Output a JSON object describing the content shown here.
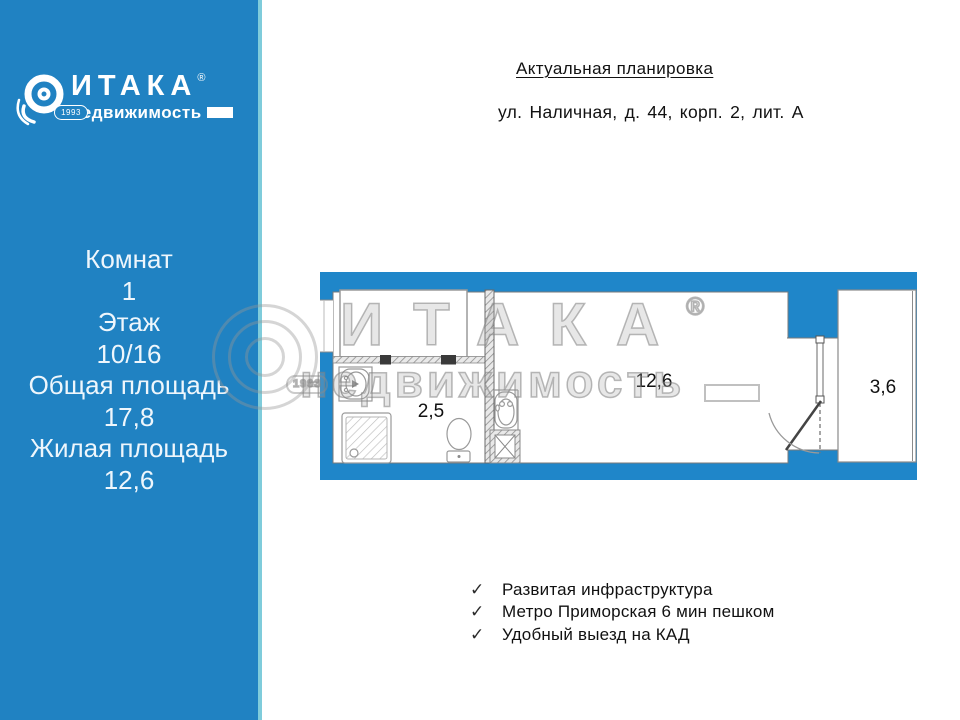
{
  "sidebar": {
    "logo": {
      "brand": "ИТАКА",
      "registered": "®",
      "subtitle": "недвижимость",
      "year_badge": "1993"
    },
    "details": [
      "Комнат",
      "1",
      "Этаж",
      "10/16",
      "Общая площадь",
      "17,8",
      "Жилая площадь",
      "12,6"
    ]
  },
  "header": {
    "title": "Актуальная планировка",
    "address": "ул. Наличная, д. 44, корп. 2, лит. А"
  },
  "floor_plan": {
    "room_labels": {
      "bathroom": "2,5",
      "living_room": "12,6",
      "balcony": "3,6"
    }
  },
  "features": {
    "check_icon": "✓",
    "items": [
      "Развитая инфраструктура",
      "Метро Приморская 6 мин пешком",
      "Удобный выезд на КАД"
    ]
  },
  "watermark": {
    "brand": "ИТАКА",
    "registered": "®",
    "subtitle": "недвижимость",
    "year": "1993"
  },
  "colors": {
    "sidebar_blue": "#2082c2",
    "plan_wall_blue": "#1f86c9",
    "sidebar_edge": "#7fccdb",
    "watermark_gray": "#8c8c8c"
  }
}
